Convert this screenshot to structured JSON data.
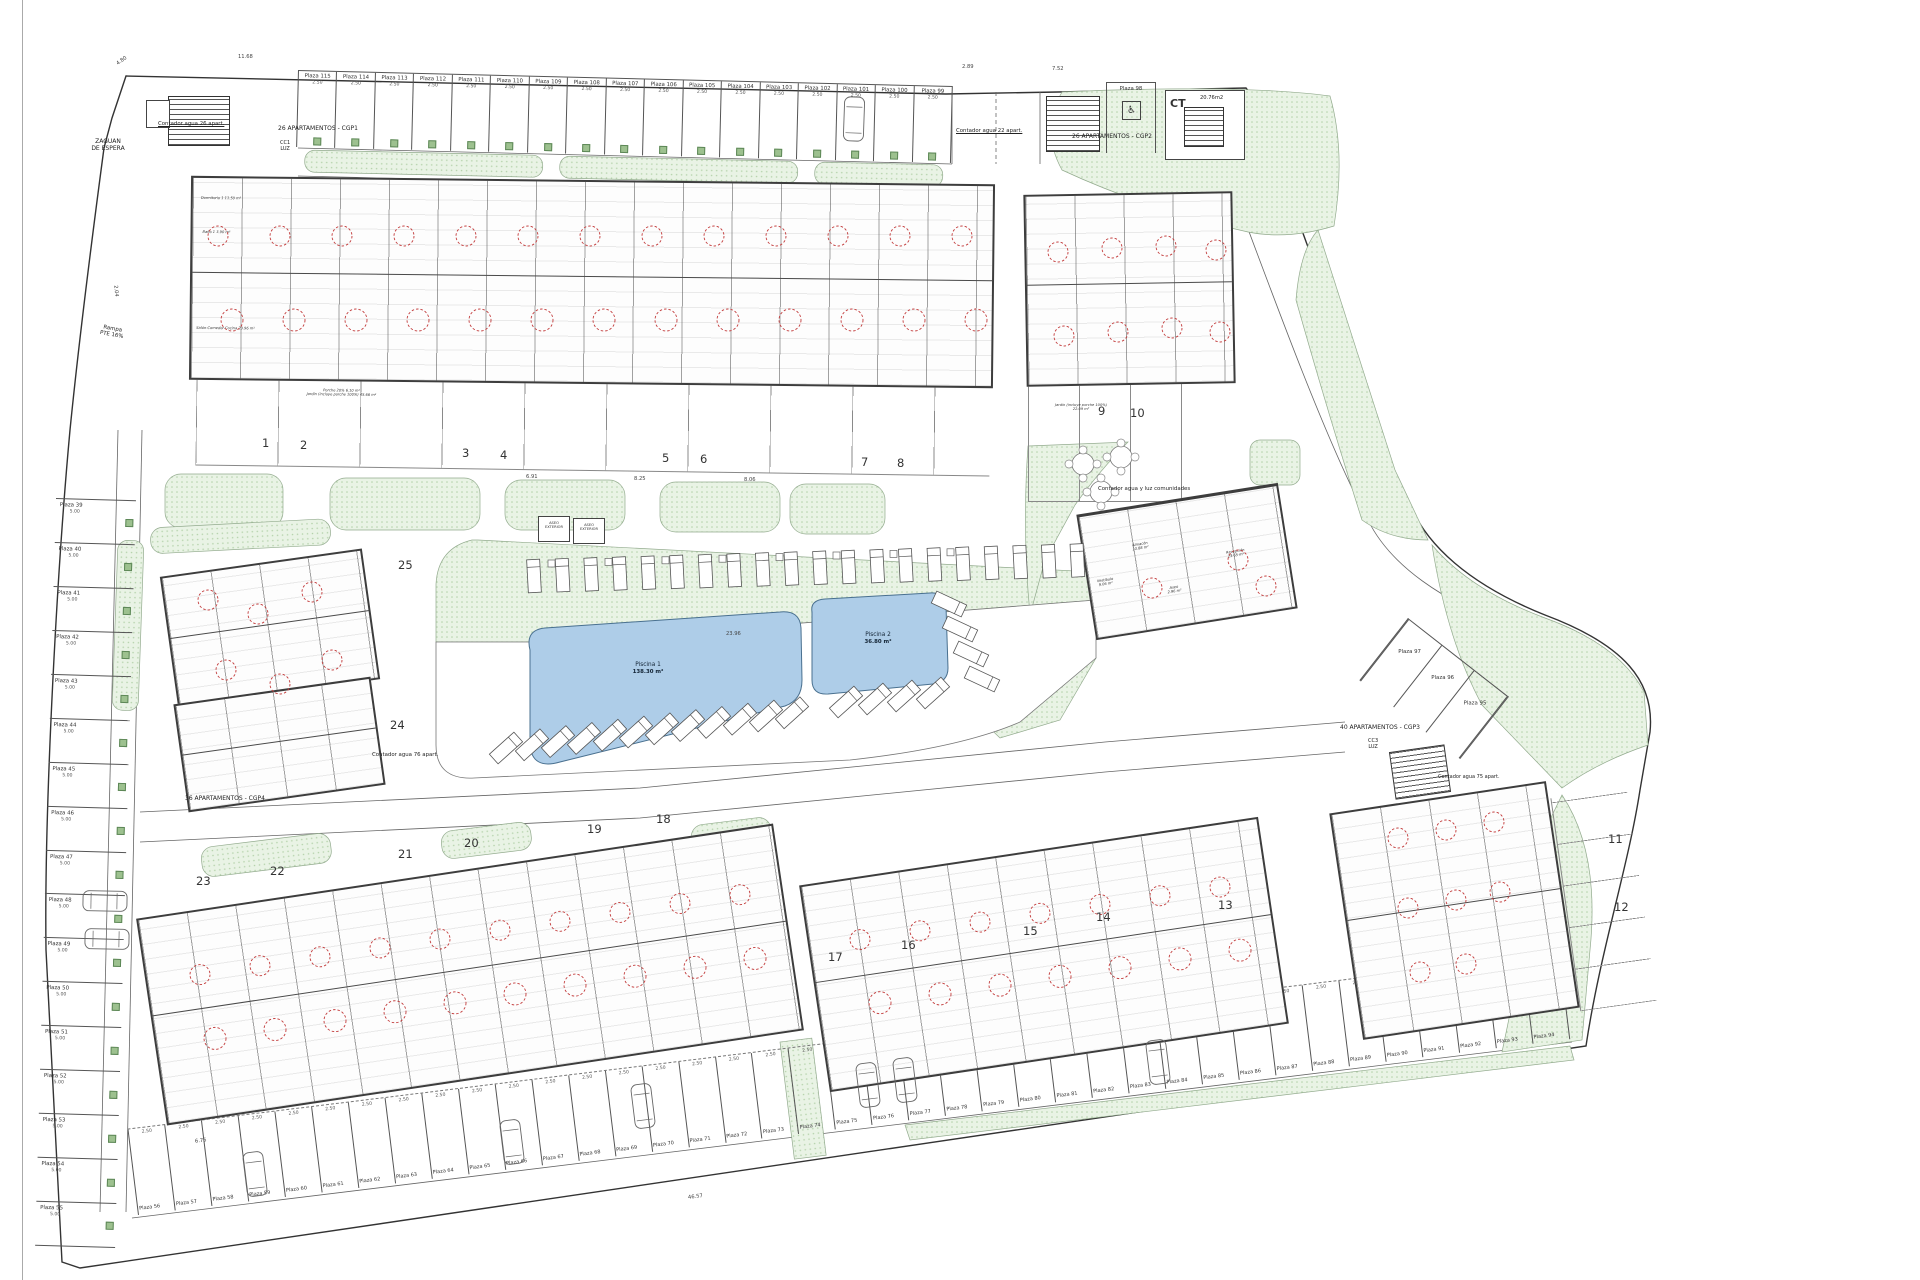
{
  "drawing": {
    "type": "residential site plan"
  },
  "labels": {
    "zaguan": "ZAGUAN\nDE ESPERA",
    "rampa": "Rampa\nPTE 16%",
    "contador26": "Contador agua 26 apart.",
    "contador22": "Contador agua 22 apart.",
    "contador76": "Contador agua 76 apart.",
    "contador75": "Contador agua 75 apart.",
    "contadorCom": "Contador agua y luz comunidades",
    "cgp1": "26 APARTAMENTOS - CGP1",
    "cgp2": "26 APARTAMENTOS - CGP2",
    "cgp3": "40 APARTAMENTOS - CGP3",
    "cgp4": "36 APARTAMENTOS - CGP4",
    "cc1": "CC1\nLUZ",
    "cc3": "CC3\nLUZ",
    "ct": "CT",
    "ctArea": "20.76m2",
    "aseo": "ASEO\nEXTERIOR"
  },
  "pools": [
    {
      "name": "Piscina 1",
      "area": "138.30 m²"
    },
    {
      "name": "Piscina 2",
      "area": "36.80 m²"
    }
  ],
  "plots": [
    "1",
    "2",
    "3",
    "4",
    "5",
    "6",
    "7",
    "8",
    "9",
    "10",
    "11",
    "12",
    "13",
    "14",
    "15",
    "16",
    "17",
    "18",
    "19",
    "20",
    "21",
    "22",
    "23",
    "24",
    "25"
  ],
  "parking": {
    "top": {
      "dim": "2.50",
      "stalls": [
        "Plaza 115",
        "Plaza 114",
        "Plaza 113",
        "Plaza 112",
        "Plaza 111",
        "Plaza 110",
        "Plaza 109",
        "Plaza 108",
        "Plaza 107",
        "Plaza 106",
        "Plaza 105",
        "Plaza 104",
        "Plaza 103",
        "Plaza 102",
        "Plaza 101",
        "Plaza 100",
        "Plaza 99"
      ]
    },
    "left": {
      "dim": "5.00",
      "stalls": [
        "Plaza 39",
        "Plaza 40",
        "Plaza 41",
        "Plaza 42",
        "Plaza 43",
        "Plaza 44",
        "Plaza 45",
        "Plaza 46",
        "Plaza 47",
        "Plaza 48",
        "Plaza 49",
        "Plaza 50",
        "Plaza 51",
        "Plaza 52",
        "Plaza 53",
        "Plaza 54",
        "Plaza 55"
      ]
    },
    "bottom": {
      "dim": "2.50",
      "stalls": [
        "Plaza 56",
        "Plaza 57",
        "Plaza 58",
        "Plaza 59",
        "Plaza 60",
        "Plaza 61",
        "Plaza 62",
        "Plaza 63",
        "Plaza 64",
        "Plaza 65",
        "Plaza 66",
        "Plaza 67",
        "Plaza 68",
        "Plaza 69",
        "Plaza 70",
        "Plaza 71",
        "Plaza 72",
        "Plaza 73",
        "Plaza 74",
        "Plaza 75",
        "Plaza 76",
        "Plaza 77",
        "Plaza 78",
        "Plaza 79",
        "Plaza 80",
        "Plaza 81",
        "Plaza 82",
        "Plaza 83",
        "Plaza 84",
        "Plaza 85",
        "Plaza 86",
        "Plaza 87",
        "Plaza 88",
        "Plaza 89",
        "Plaza 90",
        "Plaza 91",
        "Plaza 92",
        "Plaza 93",
        "Plaza 94"
      ]
    },
    "curve": {
      "stalls": [
        "Plaza 97",
        "Plaza 96",
        "Plaza 95"
      ]
    },
    "isolated": {
      "label": "Plaza 98"
    }
  },
  "rooms": {
    "typical": [
      {
        "name": "Dormitorio 1",
        "area": "11.50 m²"
      },
      {
        "name": "Dormitorio 2",
        "area": "10.70 m²"
      },
      {
        "name": "Dormitorio 3",
        "area": "9.04 m²"
      },
      {
        "name": "Baño 1",
        "area": "3.90 m²"
      },
      {
        "name": "Baño 2",
        "area": "3.66 m²"
      },
      {
        "name": "Paso",
        "area": "4.60 m²"
      },
      {
        "name": "Salón-Comedor-Cocina",
        "area": "23.96 m²"
      },
      {
        "name": "Porche 20%",
        "area": "6.10 m²"
      },
      {
        "name": "Jardín (incluye porche 100%)",
        "area": "45.66 m²"
      }
    ],
    "jardin_areas_seen": [
      "45.66 m²",
      "22.09 m²",
      "49.29 m²",
      "36.98 m²",
      "20.98 m²"
    ],
    "communal": [
      {
        "name": "Almacén",
        "area": "13.88 m²"
      },
      {
        "name": "Recepción",
        "area": "23.65 m²"
      },
      {
        "name": "Vestíbulo",
        "area": "9.06 m²"
      },
      {
        "name": "Aseo",
        "area": "2.96 m²"
      }
    ]
  },
  "dims": [
    "11.68",
    "2.89",
    "7.52",
    "6.91",
    "8.25",
    "8.06",
    "23.96",
    "46.57",
    "6.75",
    "2.04",
    "4.80"
  ],
  "icons": {
    "handicap": "♿"
  }
}
